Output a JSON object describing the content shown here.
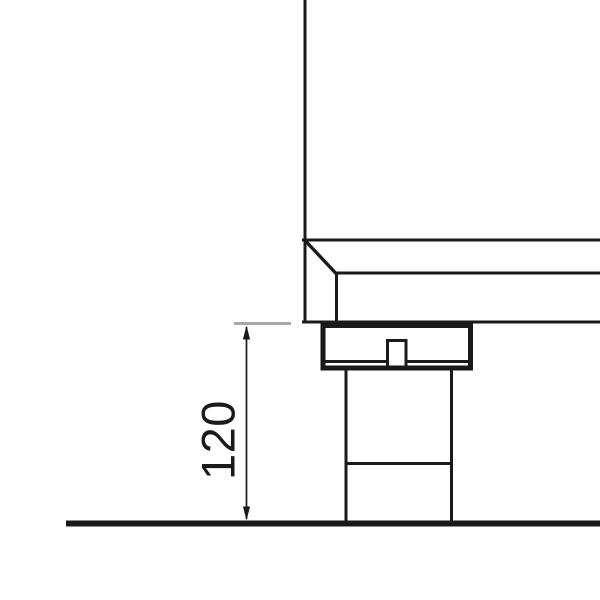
{
  "drawing": {
    "type": "technical-drawing",
    "dimension_label": "120"
  },
  "colors": {
    "line": "#1a1a1a",
    "extension_line": "#a8a8a8",
    "background": "#ffffff"
  },
  "icons": {
    "dimension_arrow_top": "arrow-up",
    "dimension_arrow_bottom": "arrow-down"
  }
}
